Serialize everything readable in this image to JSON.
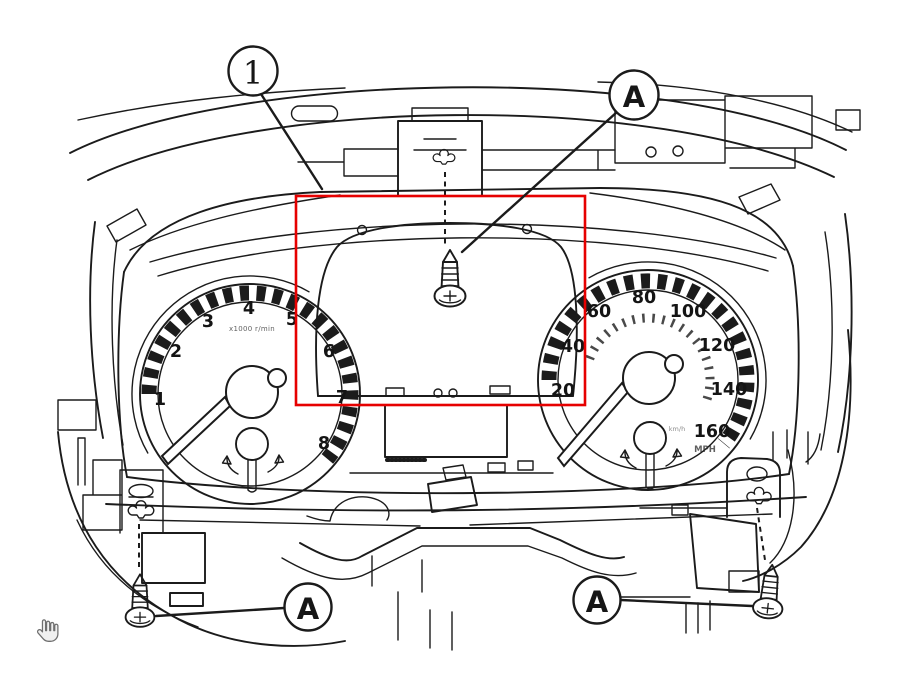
{
  "colors": {
    "line": "#1b1b1b",
    "highlight_box": "#e60000",
    "background": "#ffffff",
    "cursor_fill": "#f0f0f0",
    "cursor_outline": "#6f6f6f"
  },
  "callouts": {
    "part_number": "1",
    "screw_label": "A"
  },
  "tachometer": {
    "numbers": [
      "1",
      "2",
      "3",
      "4",
      "5",
      "6",
      "7",
      "8"
    ],
    "unit_text": "x1000 r/min"
  },
  "speedometer": {
    "numbers": [
      "20",
      "40",
      "60",
      "80",
      "100",
      "120",
      "140",
      "160"
    ],
    "unit_primary": "MPH",
    "unit_secondary": "km/h"
  },
  "cursor": {
    "type": "hand-pointer"
  }
}
